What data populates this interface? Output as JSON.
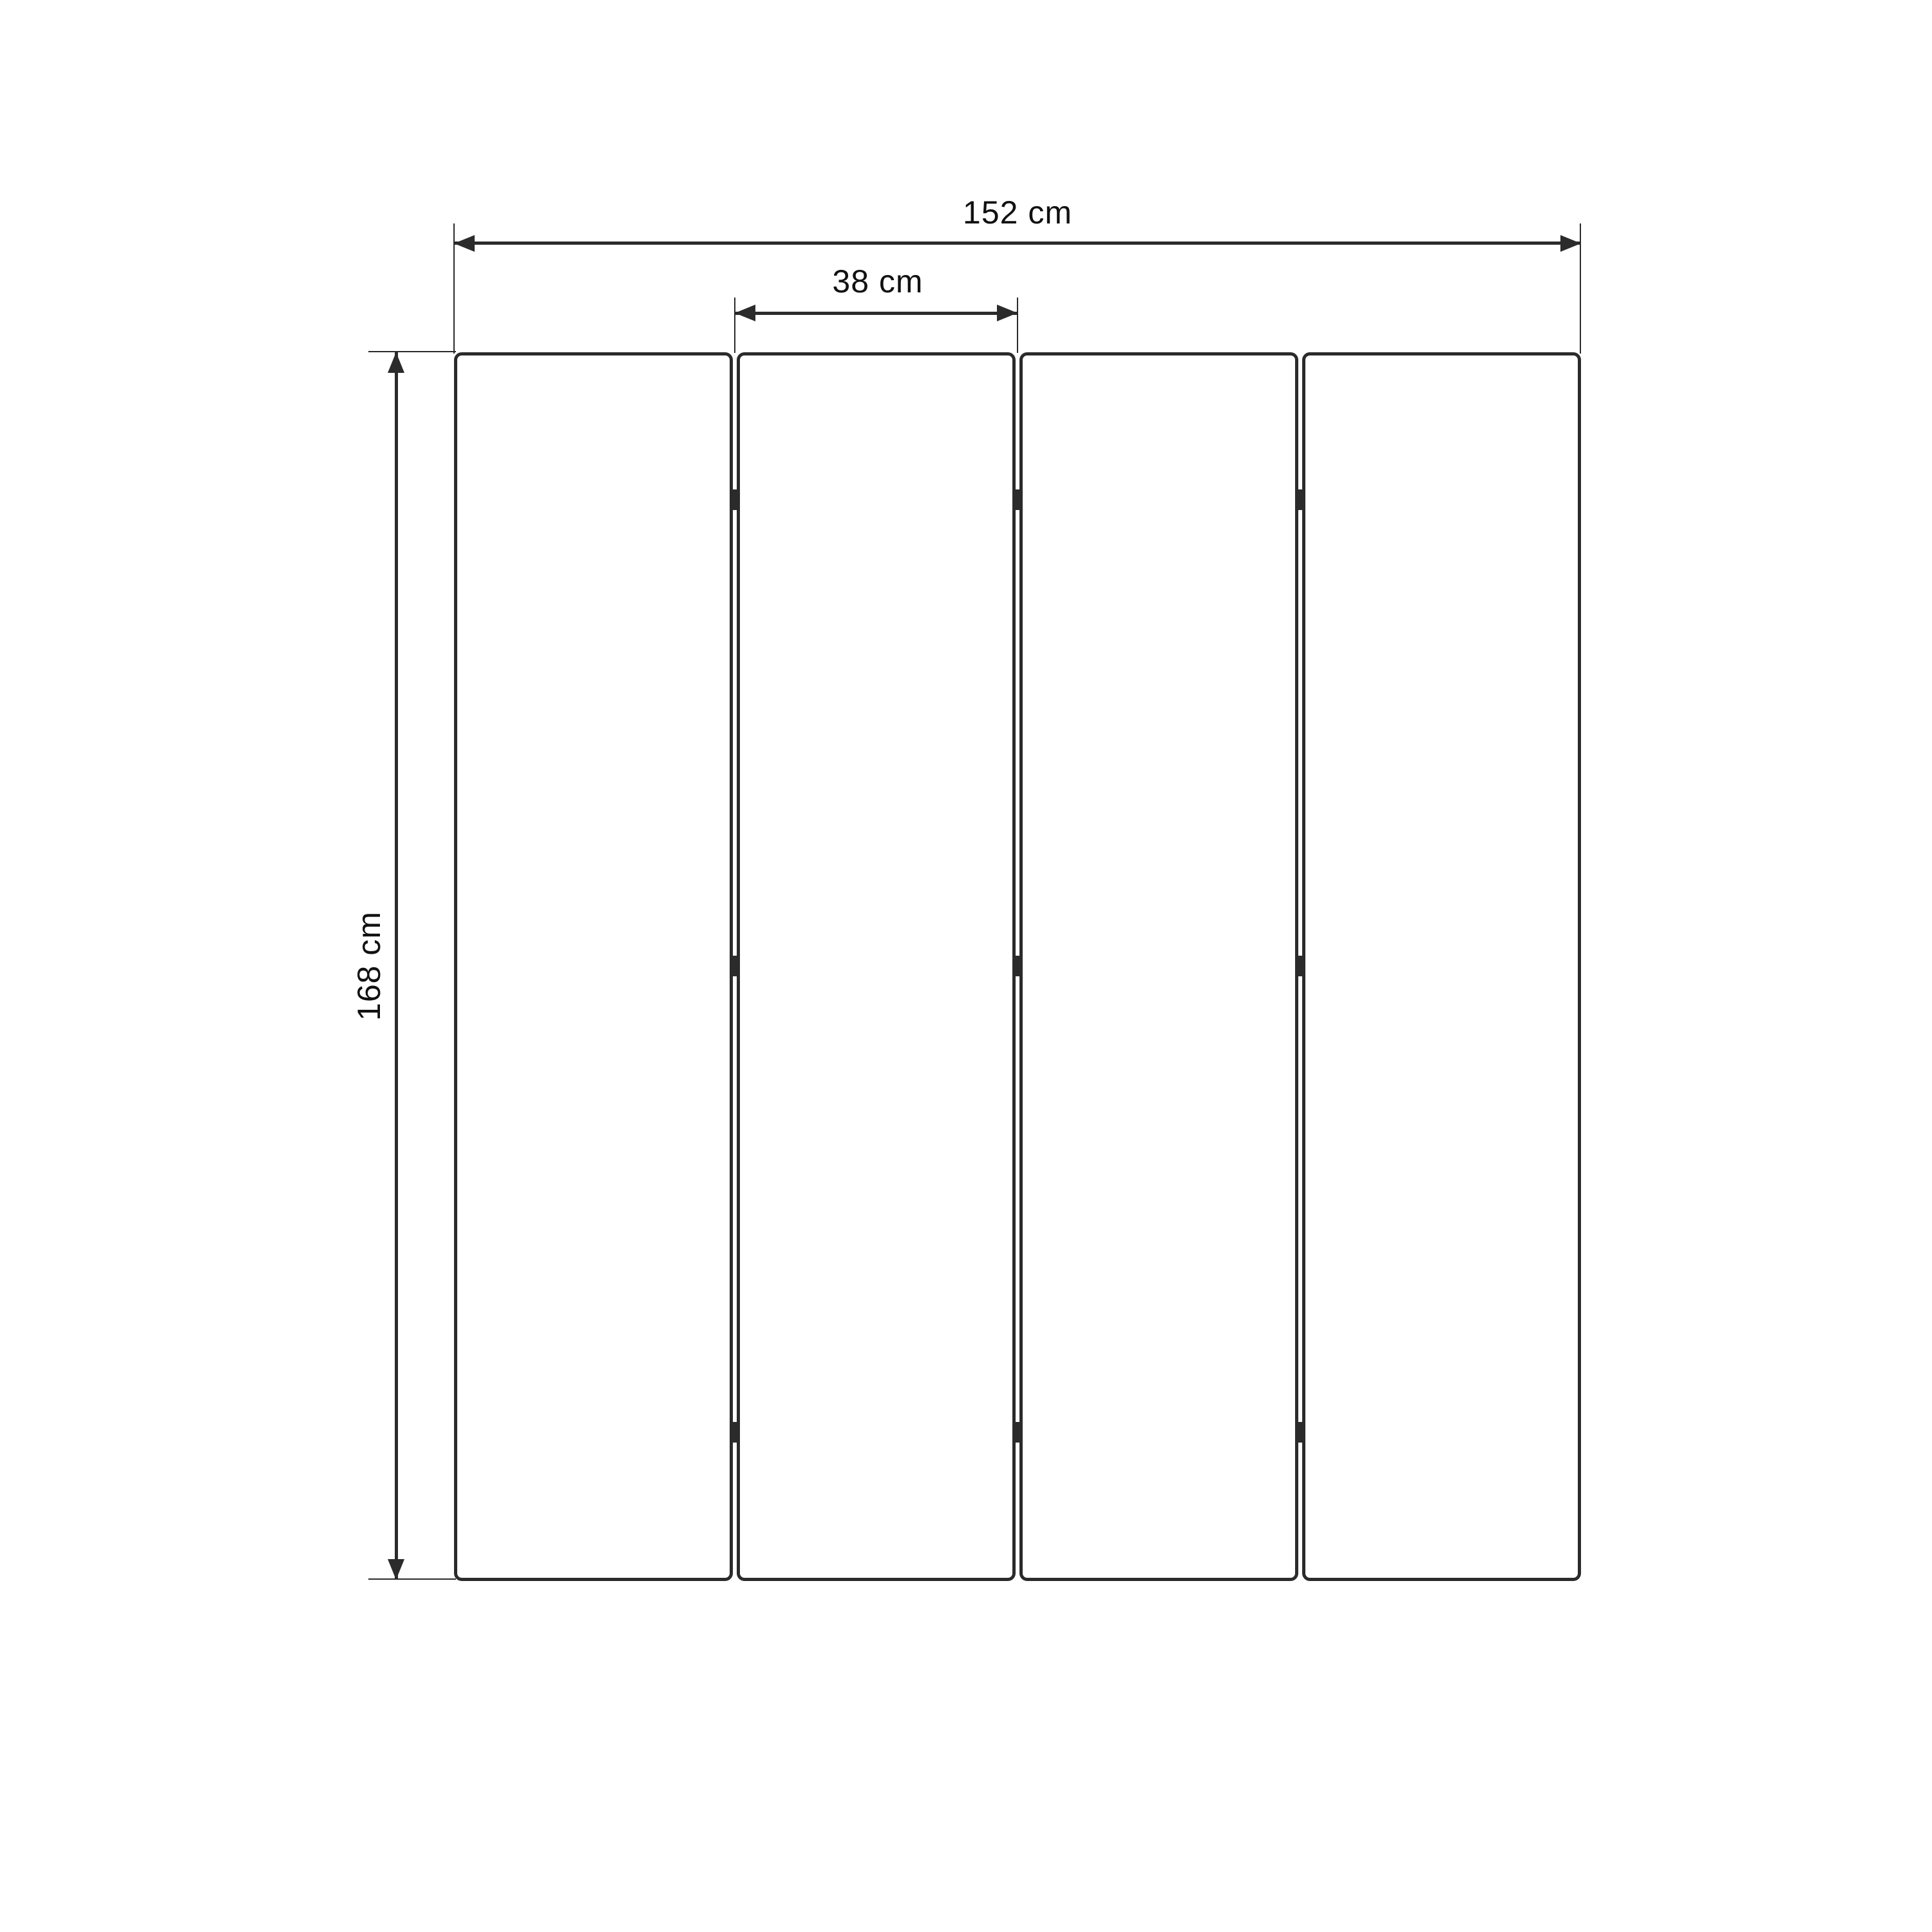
{
  "diagram": {
    "type": "dimension-drawing",
    "subject": "four-panel folding screen, front elevation",
    "panel_count": 4,
    "hinge_rows": 3,
    "dimensions": {
      "total_width": {
        "value": 152,
        "unit": "cm",
        "label": "152 cm"
      },
      "panel_width": {
        "value": 38,
        "unit": "cm",
        "label": "38 cm"
      },
      "height": {
        "value": 168,
        "unit": "cm",
        "label": "168 cm"
      }
    },
    "colors": {
      "background": "#ffffff",
      "line": "#2b2b2b",
      "text": "#111111"
    }
  }
}
